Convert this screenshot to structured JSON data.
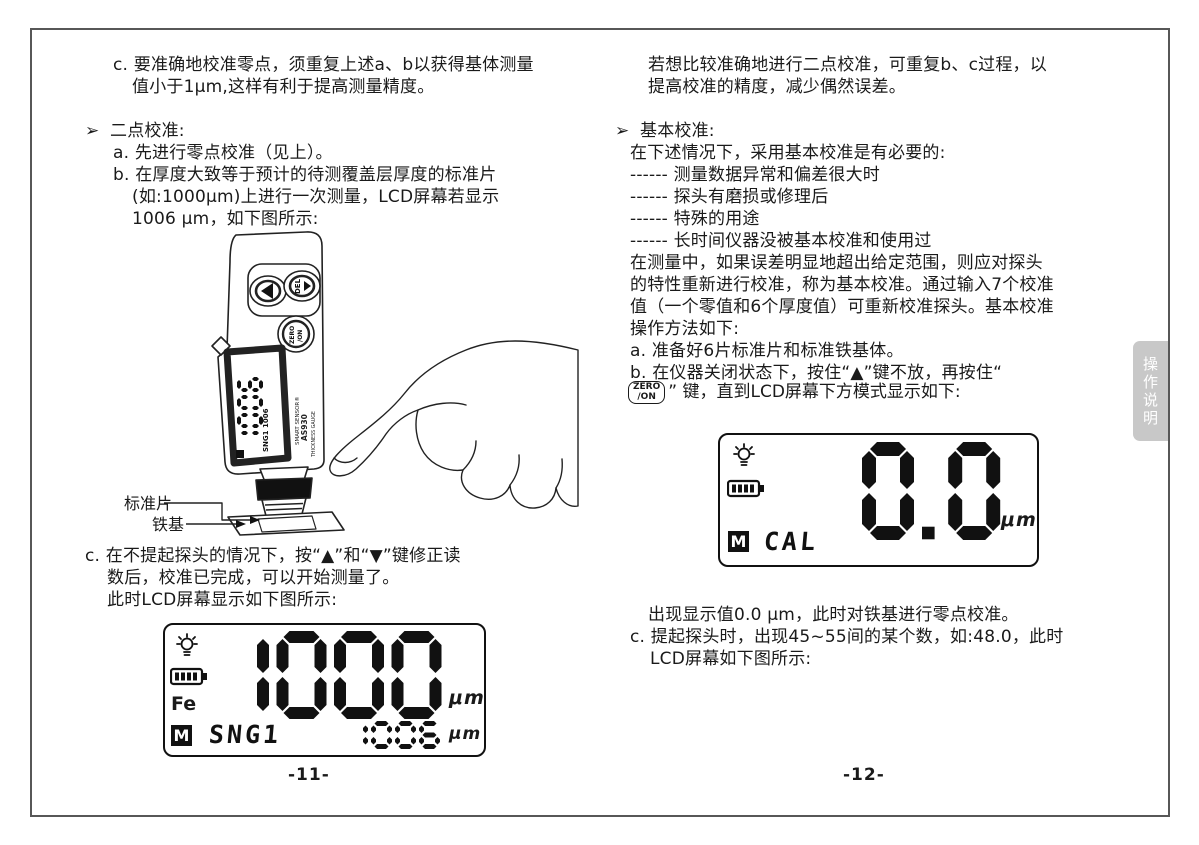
{
  "colors": {
    "ink": "#1a1a1a",
    "tab_bg": "#c8c8c8",
    "tab_text": "#ffffff",
    "frame": "#575757"
  },
  "left": {
    "c_top_1": "c. 要准确地校准零点，须重复上述a、b以获得基体测量",
    "c_top_2": "值小于1μm,这样有利于提高测量精度。",
    "bullet": "➢",
    "section_title": "二点校准:",
    "item_a": "a. 先进行零点校准（见上）。",
    "item_b_1": "b. 在厚度大致等于预计的待测覆盖层厚度的标准片",
    "item_b_2": "(如:1000μm)上进行一次测量，LCD屏幕若显示",
    "item_b_3": "1006 μm，如下图所示:",
    "label_standard_sheet": "标准片",
    "label_iron_base": "铁基",
    "item_c_1": "c. 在不提起探头的情况下，按“▲”和“▼”键修正读",
    "item_c_2": "数后，校准已完成，可以开始测量了。",
    "item_c_3": "此时LCD屏幕显示如下图所示:",
    "page_number": "-11-",
    "lcd": {
      "value": "1000",
      "unit": "μm",
      "fe_label": "Fe",
      "mode_badge": "M",
      "sub_text": "SNG1",
      "sub_value": "1006",
      "sub_unit": "μm"
    },
    "device": {
      "brand": "SMART SENSOR®",
      "model": "AS930",
      "model_caption": "THICKNESS GAUGE",
      "screen_value": "1006",
      "screen_sub": "SNG1 1006",
      "btn_del": "DEL",
      "btn_zero_line1": "ZERO",
      "btn_zero_line2": "/ON"
    }
  },
  "right": {
    "intro_1": "若想比较准确地进行二点校准，可重复b、c过程，以",
    "intro_2": "提高校准的精度，减少偶然误差。",
    "bullet": "➢",
    "section_title": "基本校准:",
    "cond_head": "在下述情况下，采用基本校准是有必要的:",
    "cond_1": "------ 测量数据异常和偏差很大时",
    "cond_2": "------ 探头有磨损或修理后",
    "cond_3": "------ 特殊的用途",
    "cond_4": "------ 长时间仪器没被基本校准和使用过",
    "body_1": "在测量中，如果误差明显地超出给定范围，则应对探头",
    "body_2": "的特性重新进行校准，称为基本校准。通过输入7个校准",
    "body_3": "值（一个零值和6个厚度值）可重新校准探头。基本校准",
    "body_4": "操作方法如下:",
    "item_a": "a. 准备好6片标准片和标准铁基体。",
    "item_b_1": "b. 在仪器关闭状态下，按住“▲”键不放，再按住“",
    "chip_zero_line1": "ZERO",
    "chip_zero_line2": "/ON",
    "item_b_2_rest": "” 键，直到LCD屏幕下方模式显示如下:",
    "note_zero": "出现显示值0.0 μm，此时对铁基进行零点校准。",
    "item_c_1": "c. 提起探头时，出现45~55间的某个数，如:48.0，此时",
    "item_c_2": "LCD屏幕如下图所示:",
    "page_number": "-12-",
    "lcd": {
      "value": "0.0",
      "unit": "μm",
      "mode_badge": "M",
      "sub_text": "CAL"
    }
  },
  "side_tab": {
    "char_1": "操",
    "char_2": "作",
    "char_3": "说",
    "char_4": "明"
  }
}
